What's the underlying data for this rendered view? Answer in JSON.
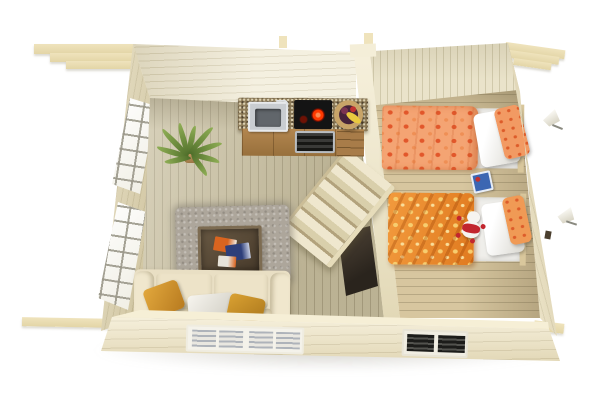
{
  "meta": {
    "title": "Log cabin interior - top-down 3D floor plan render",
    "width": 600,
    "height": 400,
    "background": "#FFFFFF",
    "view": "overhead cutaway of a two-room wooden summerhouse, walls splayed outward in perspective, roof beams protruding at corners"
  },
  "colors": {
    "beam": "#EFE3BC",
    "beamDark": "#E3D5A6",
    "wallTop": "#F1EBD6",
    "wallTopRight": "#EAE3CA",
    "wallLeft": "#E8DEBD",
    "wallRight": "#EBE1BF",
    "wallBottom": "#F3EACB",
    "wallLip": "#F6EFD6",
    "divider": "#EFE8CF",
    "floorLeft": "#CBC2A3",
    "floorRight": "#D7C69F",
    "plank": "rgba(110,100,70,0.30)",
    "granite": "#8D7B58",
    "cabinet": "#B3864F",
    "steel": "#C9CDD1",
    "cooktop": "#141414",
    "burner": "#FF3A00",
    "basket": "#C8A468",
    "banana": "#E9C93F",
    "leaf": "#8FAE55",
    "pot": "#8E6A3C",
    "rug": "#ADA69B",
    "table": "#473A2B",
    "tableRim": "#7D6C52",
    "sofa": "#E9DFC4",
    "cushion": "#EDE3C8",
    "pillowMustard": "#B77A1F",
    "mattress": "#EFEEEA",
    "headboard": "#D9C79C",
    "duvet1": "#F4A473",
    "duvet1Dot": "#E2572B",
    "duvet2": "#E07A1F",
    "duvet2Dot": "#F7CD6F",
    "doorDark": "#2A241D",
    "stairLight": "#EFE7CE",
    "stairShadow": "#B2A27C",
    "toyBlue": "#3B66B2",
    "teddyRed": "#C2262E",
    "slatGray": "#AEB3BA",
    "ventDark": "#1C1C1A",
    "shadow": "rgba(140,135,120,0.35)"
  },
  "scene": {
    "rooms": [
      {
        "name": "living room with kitchenette",
        "floor_planks": "vertical",
        "position": "left"
      },
      {
        "name": "bedroom",
        "floor_planks": "horizontal",
        "position": "right"
      }
    ]
  },
  "objects": {
    "roof_beams_tl": {
      "label": "Stepped roof purlins protruding at top-left corner"
    },
    "roof_beams_tr": {
      "label": "Stepped roof purlins protruding at top-right corner"
    },
    "beam_bl": {
      "label": "Wall log end protruding at bottom-left"
    },
    "beam_br": {
      "label": "Wall log end protruding at bottom-right"
    },
    "wall_top": {
      "label": "Rear log wall, interior face"
    },
    "wall_left": {
      "label": "Left log wall with two tall windows"
    },
    "wall_right": {
      "label": "Right log wall"
    },
    "wall_bottom": {
      "label": "Front log wall, exterior face"
    },
    "divider": {
      "label": "Interior partition wall between rooms"
    },
    "window_left_1": {
      "label": "Tall multi-pane window, upper left wall"
    },
    "window_left_2": {
      "label": "Tall multi-pane window, lower left wall"
    },
    "window_bottom": {
      "label": "Double front window with white blinds"
    },
    "vent_bottom": {
      "label": "Dark louvered bedroom window"
    },
    "counter": {
      "label": "Kitchen counter with granite worktop"
    },
    "sink": {
      "label": "Stainless steel sink with faucet"
    },
    "cooktop": {
      "label": "Black glass cooktop with glowing red burner"
    },
    "oven": {
      "label": "Built-in oven below cooktop"
    },
    "drawers": {
      "label": "Cabinet drawers"
    },
    "fruit_basket": {
      "label": "Woven basket with bananas and plums"
    },
    "plant": {
      "label": "Potted palm plant"
    },
    "rug": {
      "label": "Grey shaggy rug"
    },
    "table": {
      "label": "Dark wood coffee table"
    },
    "magazines": {
      "label": "Magazines on coffee table"
    },
    "sofa": {
      "label": "Cream sofa"
    },
    "sofa_pillows": {
      "label": "Two mustard pillows and one white pillow"
    },
    "stairs": {
      "label": "Compact alternating-tread loft staircase"
    },
    "door": {
      "label": "Dark door standing open beside staircase"
    },
    "bed1": {
      "label": "Single bed with peach floral duvet and white pillow"
    },
    "bed2": {
      "label": "Single bed with orange floral duvet and white pillow"
    },
    "teddy": {
      "label": "Red and white teddy bear on bed"
    },
    "toy_book": {
      "label": "Small blue book on bedroom floor"
    },
    "lamp1": {
      "label": "Wall lamp above first bed"
    },
    "lamp2": {
      "label": "Wall lamp above second bed"
    }
  }
}
